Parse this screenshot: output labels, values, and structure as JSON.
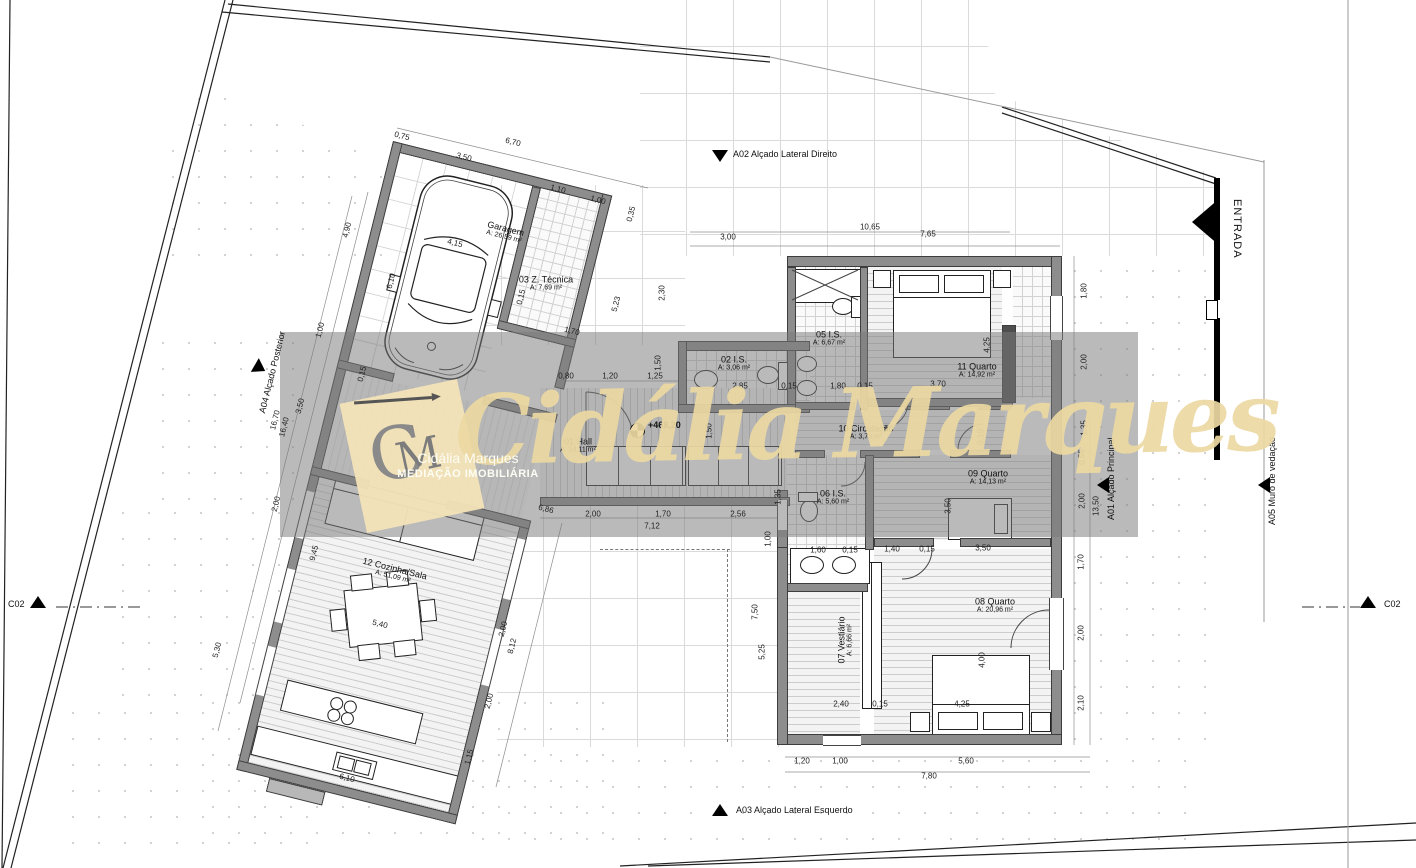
{
  "colors": {
    "wall": "#8d8d8d",
    "wall_dark": "#4e4e4e",
    "watermark_band": "rgba(122,122,122,0.52)",
    "watermark_gold": "#ecd9a2",
    "logo_card": "#f3e3b7",
    "line": "#3d3d3d"
  },
  "drawing": {
    "level_label": "+468,20",
    "watermark": {
      "script": "Cidália Marques",
      "brand_name": "Cidália Marques",
      "brand_tagline": "MEDIAÇÃO IMOBILIÁRIA",
      "monogram_c": "C",
      "monogram_m": "M"
    },
    "markers": {
      "a01": "A01 Alçado Principal",
      "a02": "A02 Alçado Lateral Direito",
      "a03": "A03 Alçado Lateral Esquerdo",
      "a04": "A04 Alçado Posterior",
      "a05": "A05 Muro de vedação",
      "entrada": "ENTRADA",
      "c02_left": "C02",
      "c02_right": "C02"
    },
    "rooms": [
      {
        "name": "Garagem",
        "area": "A: 26,59 m²",
        "x": 505,
        "y": 232,
        "r": 14
      },
      {
        "name": "03 Z. Técnica",
        "area": "A: 7,69 m²",
        "x": 546,
        "y": 283,
        "r": 0
      },
      {
        "name": "01 Hall",
        "area": "A: 14,11 m²",
        "x": 578,
        "y": 445,
        "r": 0
      },
      {
        "name": "02 I.S.",
        "area": "A: 3,06 m²",
        "x": 734,
        "y": 363,
        "r": 0
      },
      {
        "name": "05 I.S.",
        "area": "A: 6,67 m²",
        "x": 829,
        "y": 338,
        "r": 0
      },
      {
        "name": "06 I.S.",
        "area": "A: 5,60 m²",
        "x": 833,
        "y": 497,
        "r": 0
      },
      {
        "name": "07 Vestiário",
        "area": "A: 6,66 m²",
        "x": 845,
        "y": 640,
        "r": -90
      },
      {
        "name": "08 Quarto",
        "area": "A: 20,96 m²",
        "x": 995,
        "y": 605,
        "r": 0
      },
      {
        "name": "09 Quarto",
        "area": "A: 14,13 m²",
        "x": 988,
        "y": 477,
        "r": 0
      },
      {
        "name": "10 Circulação",
        "area": "A: 3,73 m²",
        "x": 866,
        "y": 432,
        "r": 0
      },
      {
        "name": "11 Quarto",
        "area": "A: 14,92 m²",
        "x": 977,
        "y": 370,
        "r": 0
      },
      {
        "name": "12 Cozinha/Sala",
        "area": "A: 51,09 m²",
        "x": 394,
        "y": 572,
        "r": 14
      }
    ],
    "dims": [
      {
        "t": "0,75",
        "x": 402,
        "y": 136,
        "r": 14
      },
      {
        "t": "6,70",
        "x": 513,
        "y": 142,
        "r": 14
      },
      {
        "t": "3,50",
        "x": 464,
        "y": 157,
        "r": 14
      },
      {
        "t": "1,10",
        "x": 558,
        "y": 189,
        "r": 14
      },
      {
        "t": "1,00",
        "x": 598,
        "y": 200,
        "r": 14
      },
      {
        "t": "0,35",
        "x": 631,
        "y": 214,
        "r": -76
      },
      {
        "t": "4,15",
        "x": 455,
        "y": 243,
        "r": 14
      },
      {
        "t": "4,90",
        "x": 347,
        "y": 230,
        "r": -76
      },
      {
        "t": "6,10",
        "x": 391,
        "y": 281,
        "r": -76
      },
      {
        "t": "0,15",
        "x": 521,
        "y": 297,
        "r": -76
      },
      {
        "t": "1,70",
        "x": 572,
        "y": 331,
        "r": 14
      },
      {
        "t": "5,23",
        "x": 616,
        "y": 304,
        "r": -76
      },
      {
        "t": "2,30",
        "x": 662,
        "y": 293,
        "r": -90
      },
      {
        "t": "1,00",
        "x": 320,
        "y": 330,
        "r": -76
      },
      {
        "t": "0,15",
        "x": 362,
        "y": 374,
        "r": -76
      },
      {
        "t": "3,50",
        "x": 300,
        "y": 406,
        "r": -76
      },
      {
        "t": "16,70",
        "x": 275,
        "y": 420,
        "r": -76
      },
      {
        "t": "16,40",
        "x": 284,
        "y": 427,
        "r": -76
      },
      {
        "t": "2,00",
        "x": 276,
        "y": 504,
        "r": -76
      },
      {
        "t": "9,45",
        "x": 314,
        "y": 553,
        "r": -76
      },
      {
        "t": "5,30",
        "x": 217,
        "y": 650,
        "r": -76
      },
      {
        "t": "5,40",
        "x": 380,
        "y": 624,
        "r": 14
      },
      {
        "t": "6,10",
        "x": 347,
        "y": 778,
        "r": 14
      },
      {
        "t": "1,15",
        "x": 469,
        "y": 757,
        "r": -76
      },
      {
        "t": "8,12",
        "x": 512,
        "y": 646,
        "r": -76
      },
      {
        "t": "2,00",
        "x": 489,
        "y": 701,
        "r": -76
      },
      {
        "t": "2,00",
        "x": 503,
        "y": 629,
        "r": -76
      },
      {
        "t": "6,86",
        "x": 546,
        "y": 509,
        "r": 14
      },
      {
        "t": "3,00",
        "x": 728,
        "y": 237,
        "r": 0
      },
      {
        "t": "10,65",
        "x": 870,
        "y": 227,
        "r": 0
      },
      {
        "t": "7,65",
        "x": 928,
        "y": 234,
        "r": 0
      },
      {
        "t": "0,80",
        "x": 566,
        "y": 376,
        "r": 0
      },
      {
        "t": "1,20",
        "x": 610,
        "y": 376,
        "r": 0
      },
      {
        "t": "1,25",
        "x": 655,
        "y": 376,
        "r": 0
      },
      {
        "t": "1,50",
        "x": 658,
        "y": 363,
        "r": -90
      },
      {
        "t": "1,50",
        "x": 709,
        "y": 431,
        "r": -90
      },
      {
        "t": "2,85",
        "x": 740,
        "y": 386,
        "r": 0
      },
      {
        "t": "0,15",
        "x": 789,
        "y": 386,
        "r": 0
      },
      {
        "t": "1,80",
        "x": 838,
        "y": 386,
        "r": 0
      },
      {
        "t": "0,15",
        "x": 865,
        "y": 386,
        "r": 0
      },
      {
        "t": "2,00",
        "x": 593,
        "y": 514,
        "r": 0
      },
      {
        "t": "1,70",
        "x": 663,
        "y": 514,
        "r": 0
      },
      {
        "t": "2,56",
        "x": 738,
        "y": 514,
        "r": 0
      },
      {
        "t": "7,12",
        "x": 652,
        "y": 526,
        "r": 0
      },
      {
        "t": "4,25",
        "x": 987,
        "y": 345,
        "r": -90
      },
      {
        "t": "3,70",
        "x": 938,
        "y": 384,
        "r": 0
      },
      {
        "t": "0,10",
        "x": 981,
        "y": 437,
        "r": -90
      },
      {
        "t": "3,50",
        "x": 948,
        "y": 506,
        "r": -90
      },
      {
        "t": "1,60",
        "x": 818,
        "y": 550,
        "r": 0
      },
      {
        "t": "0,15",
        "x": 850,
        "y": 550,
        "r": 0
      },
      {
        "t": "1,40",
        "x": 892,
        "y": 549,
        "r": 0
      },
      {
        "t": "0,15",
        "x": 927,
        "y": 549,
        "r": 0
      },
      {
        "t": "3,50",
        "x": 983,
        "y": 548,
        "r": 0
      },
      {
        "t": "4,00",
        "x": 982,
        "y": 660,
        "r": -90
      },
      {
        "t": "2,40",
        "x": 841,
        "y": 704,
        "r": 0
      },
      {
        "t": "0,15",
        "x": 880,
        "y": 704,
        "r": 0
      },
      {
        "t": "4,25",
        "x": 962,
        "y": 704,
        "r": 0
      },
      {
        "t": "7,50",
        "x": 755,
        "y": 612,
        "r": -90
      },
      {
        "t": "5,25",
        "x": 762,
        "y": 652,
        "r": -90
      },
      {
        "t": "1,00",
        "x": 768,
        "y": 539,
        "r": -90
      },
      {
        "t": "1,35",
        "x": 778,
        "y": 497,
        "r": -90
      },
      {
        "t": "1,80",
        "x": 1084,
        "y": 291,
        "r": -90
      },
      {
        "t": "2,00",
        "x": 1084,
        "y": 362,
        "r": -90
      },
      {
        "t": "1,35",
        "x": 1084,
        "y": 428,
        "r": -90
      },
      {
        "t": "0,55",
        "x": 1082,
        "y": 457,
        "r": -90
      },
      {
        "t": "2,00",
        "x": 1082,
        "y": 501,
        "r": -90
      },
      {
        "t": "13,50",
        "x": 1096,
        "y": 506,
        "r": -90
      },
      {
        "t": "1,70",
        "x": 1081,
        "y": 562,
        "r": -90
      },
      {
        "t": "2,00",
        "x": 1081,
        "y": 633,
        "r": -90
      },
      {
        "t": "2,10",
        "x": 1081,
        "y": 703,
        "r": -90
      },
      {
        "t": "1,20",
        "x": 802,
        "y": 761,
        "r": 0
      },
      {
        "t": "1,00",
        "x": 840,
        "y": 761,
        "r": 0
      },
      {
        "t": "5,60",
        "x": 966,
        "y": 761,
        "r": 0
      },
      {
        "t": "7,80",
        "x": 929,
        "y": 776,
        "r": 0
      }
    ]
  }
}
